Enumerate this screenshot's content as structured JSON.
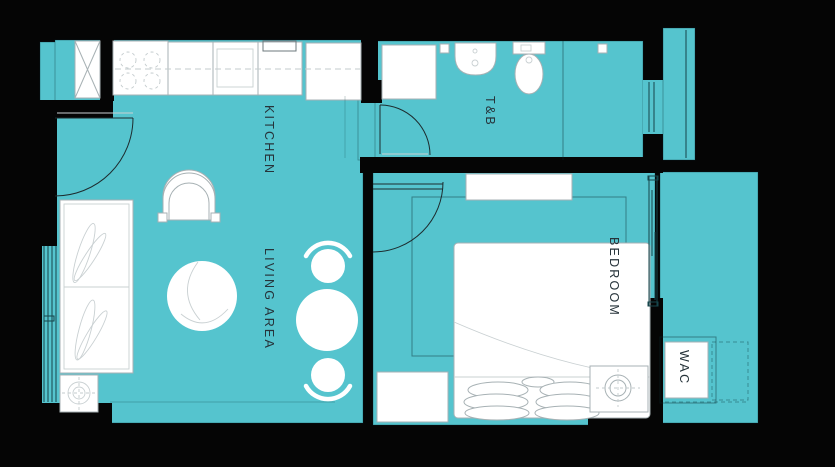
{
  "floor_plan": {
    "title": "unit-floor-plan",
    "rooms": [
      {
        "id": "kitchen",
        "label": "KITCHEN"
      },
      {
        "id": "toilet-bath",
        "label": "T&B"
      },
      {
        "id": "living-area",
        "label": "LIVING AREA"
      },
      {
        "id": "bedroom",
        "label": "BEDROOM"
      },
      {
        "id": "wac",
        "label": "WAC"
      }
    ],
    "colors": {
      "floor": "#55c4ce",
      "wall": "#050505",
      "fixture": "#ffffff",
      "outline": "#a7b1b4",
      "label": "#26333a"
    }
  }
}
